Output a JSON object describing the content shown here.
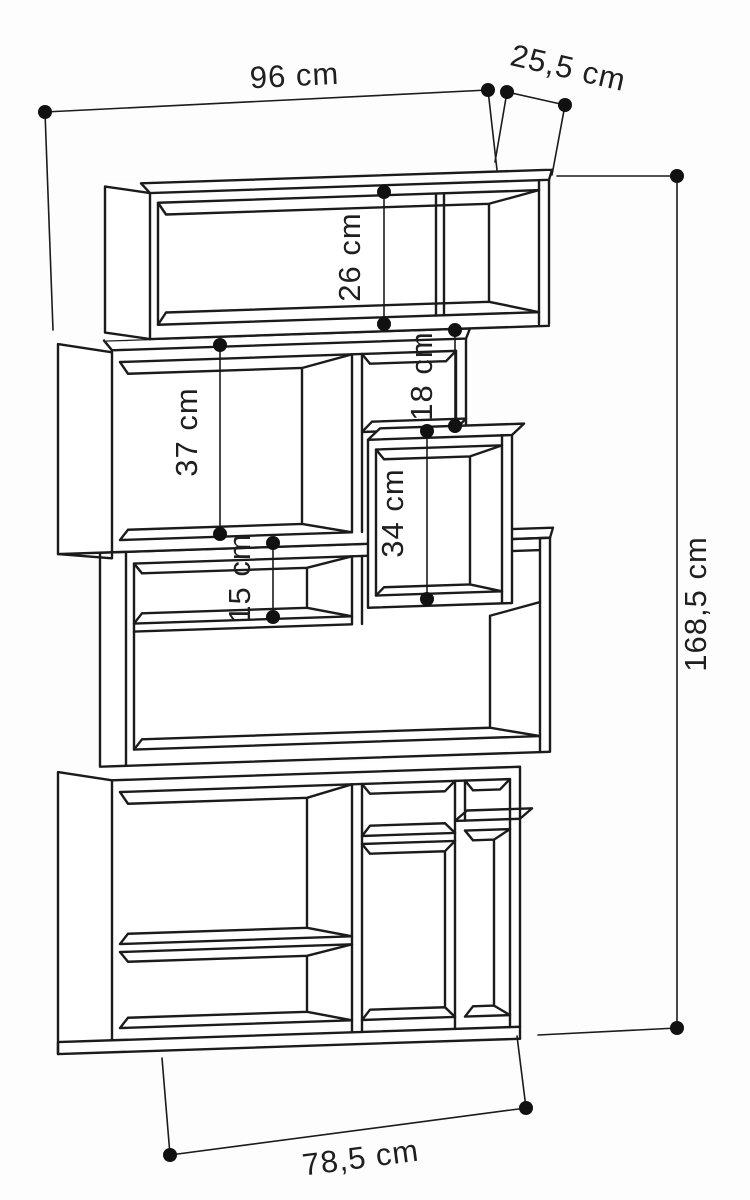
{
  "diagram": {
    "title": "bookcase dimension drawing",
    "unit": "cm",
    "line_color": "#1b1b1b",
    "background_color": "#ffffff",
    "dimensions": {
      "overall_width": {
        "label": "96 cm",
        "value": 96
      },
      "top_depth": {
        "label": "25,5 cm",
        "value": 25.5
      },
      "overall_height": {
        "label": "168,5 cm",
        "value": 168.5
      },
      "base_width": {
        "label": "78,5 cm",
        "value": 78.5
      },
      "top_compartment_height": {
        "label": "26 cm",
        "value": 26
      },
      "upper_left_compartment_height": {
        "label": "37 cm",
        "value": 37
      },
      "upper_middle_compartment_height": {
        "label": "18 cm",
        "value": 18
      },
      "middle_right_compartment_height": {
        "label": "34 cm",
        "value": 34
      },
      "middle_left_compartment_height": {
        "label": "15 cm",
        "value": 15
      }
    }
  }
}
